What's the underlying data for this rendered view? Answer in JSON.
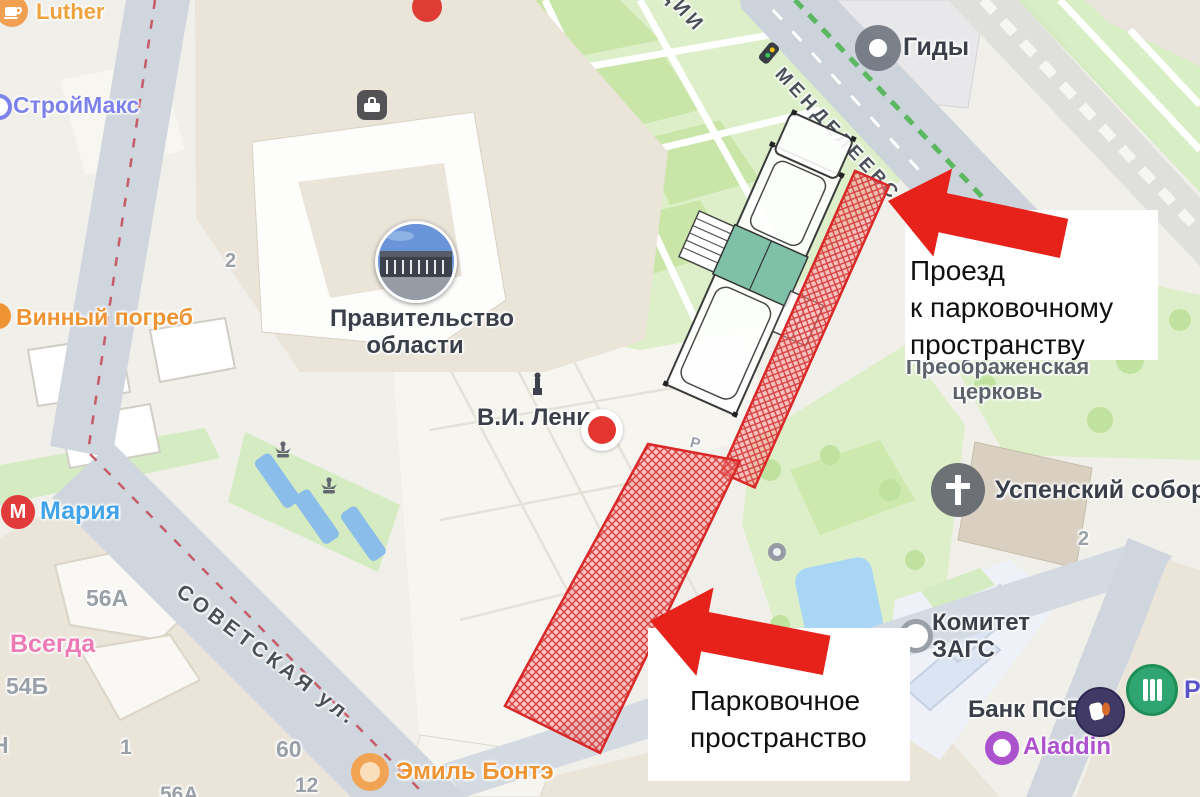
{
  "annotation": {
    "driveway": "Проезд\nк парковочному\nпространству",
    "parking": "Парковочное\nпространство"
  },
  "pois": {
    "luther": "Luther",
    "stroymax": "СтройМакс",
    "vinny_pogreb": "Винный погреб",
    "government": "Правительство\nобласти",
    "lenin": "В.И. Ленин",
    "gidy": "Гиды",
    "preobrazhenskaya": "Преображенская\nцерковь",
    "uspensky_sobor": "Успенский собор",
    "zags": "Комитет\nЗАГС",
    "bank_psb": "Банк ПСБ",
    "bank_partial": "Ро",
    "aladdin": "Aladdin",
    "emil_bonte": "Эмиль Бонтэ",
    "maria": "Мария",
    "maria_icon_letter": "М",
    "vsegda": "Всегда"
  },
  "streets": {
    "mendeleevskaya": "МЕНДЕЛЕЕВСК",
    "dii": "ДИИ",
    "sovetskaya": "СОВЕТСКАЯ ул."
  },
  "numbers": {
    "gov": "2",
    "sobor": "2",
    "b56a": "56А",
    "b54b": "54Б",
    "bN": "Н",
    "b1": "1",
    "b60": "60",
    "b12": "12",
    "b56a2": "56А",
    "parking": "Р"
  },
  "colors": {
    "annotation_red": "#e6221a",
    "hatch_red": "#da2727",
    "road_gray": "#ccd3db",
    "park_green": "#dcefc8",
    "water_blue": "#a9d6f5",
    "building_beige": "#eae4d9"
  }
}
